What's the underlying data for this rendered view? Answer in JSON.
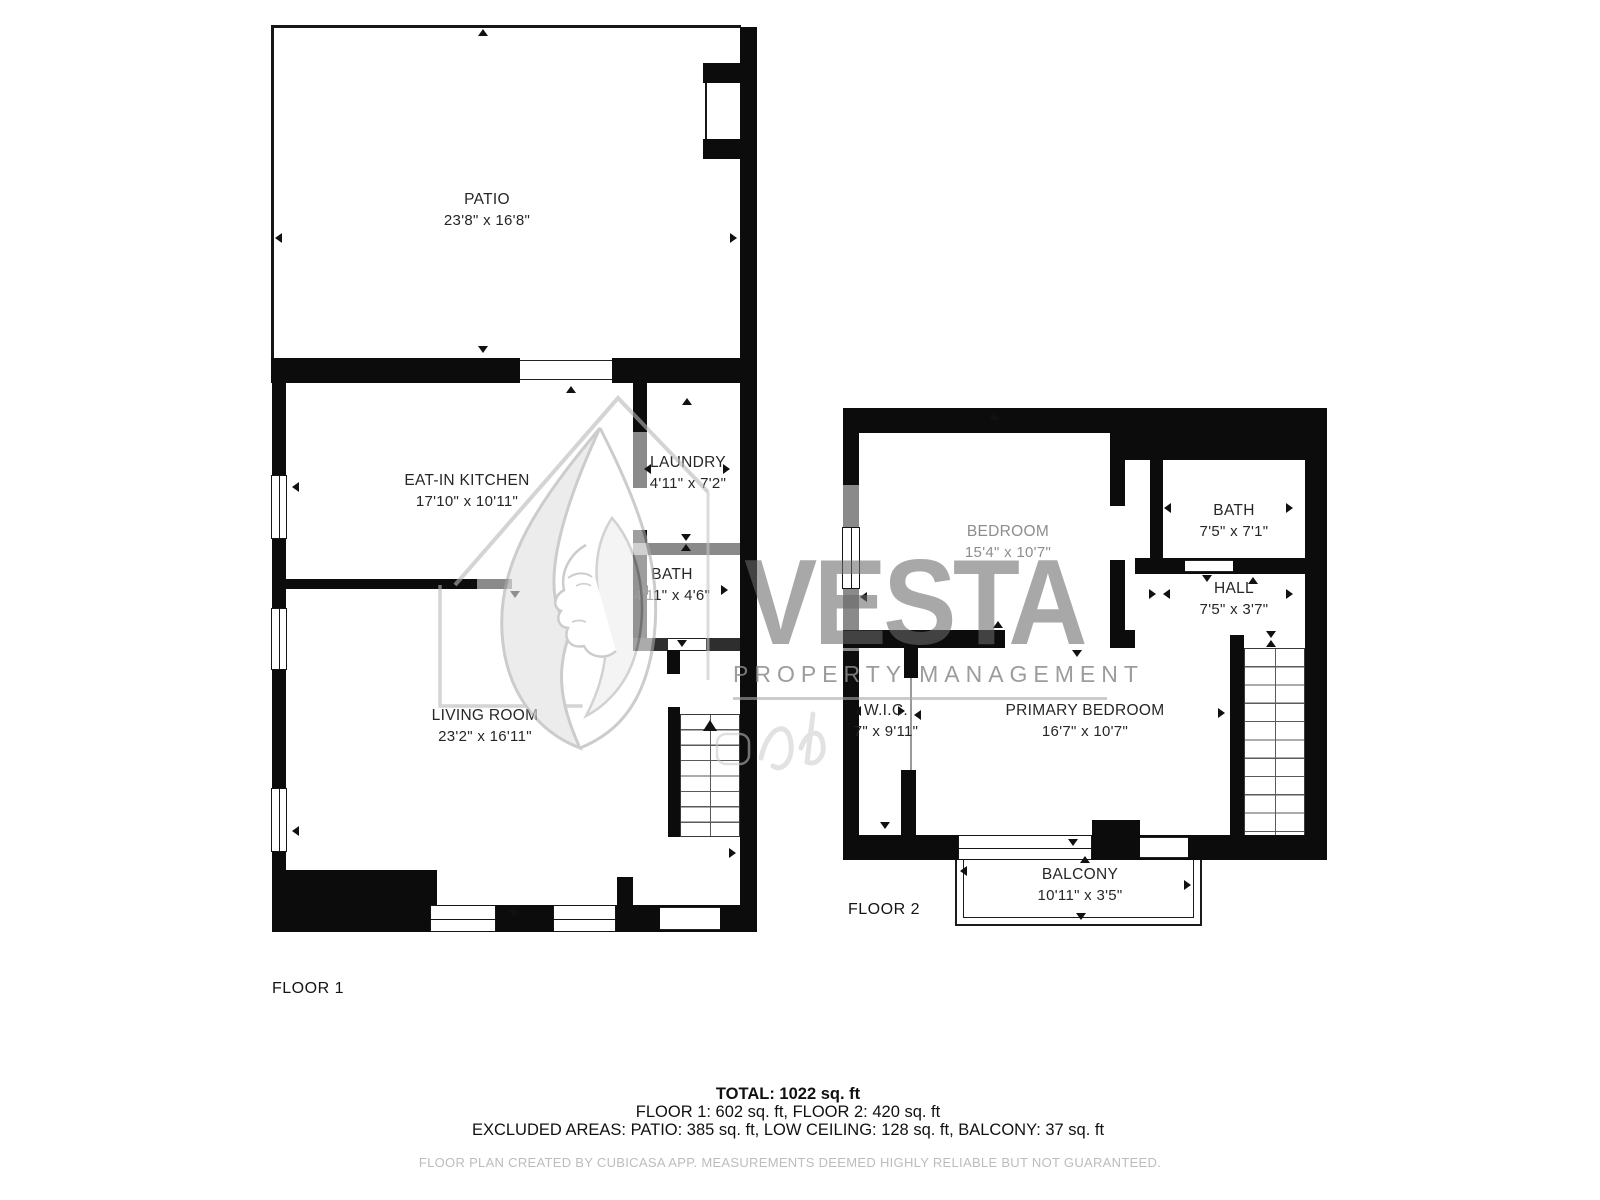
{
  "floor1": {
    "label": "FLOOR 1",
    "patio": {
      "name": "PATIO",
      "dims": "23'8\" x 16'8\""
    },
    "kitchen": {
      "name": "EAT-IN KITCHEN",
      "dims": "17'10\" x 10'11\""
    },
    "laundry": {
      "name": "LAUNDRY",
      "dims": "4'11\" x 7'2\""
    },
    "bath": {
      "name": "BATH",
      "dims": "4'11\" x 4'6\""
    },
    "living": {
      "name": "LIVING ROOM",
      "dims": "23'2\" x 16'11\""
    }
  },
  "floor2": {
    "label": "FLOOR 2",
    "bedroom": {
      "name": "BEDROOM",
      "dims": "15'4\" x 10'7\""
    },
    "bath": {
      "name": "BATH",
      "dims": "7'5\" x 7'1\""
    },
    "hall": {
      "name": "HALL",
      "dims": "7'5\" x 3'7\""
    },
    "wic": {
      "name": "W.I.C.",
      "dims": "7\" x 9'11\""
    },
    "primary": {
      "name": "PRIMARY BEDROOM",
      "dims": "16'7\" x 10'7\""
    },
    "balcony": {
      "name": "BALCONY",
      "dims": "10'11\" x 3'5\""
    }
  },
  "watermark": {
    "brand": "VESTA",
    "tagline": "PROPERTY MANAGEMENT"
  },
  "summary": {
    "total": "TOTAL: 1022 sq. ft",
    "floors": "FLOOR 1: 602 sq. ft, FLOOR 2: 420 sq. ft",
    "excluded": "EXCLUDED AREAS: PATIO: 385 sq. ft, LOW CEILING: 128 sq. ft, BALCONY: 37 sq. ft",
    "disclaimer": "FLOOR PLAN CREATED BY CUBICASA APP. MEASUREMENTS DEEMED HIGHLY RELIABLE BUT NOT GUARANTEED."
  },
  "colors": {
    "wall": "#0c0c0c",
    "low_ceiling_wall": "#8a8a8a",
    "watermark_gray": "#8b8b8b",
    "label": "#262626",
    "bedroom_label_gray": "#8d8d8d",
    "footer_gray": "#bcbcbc"
  }
}
